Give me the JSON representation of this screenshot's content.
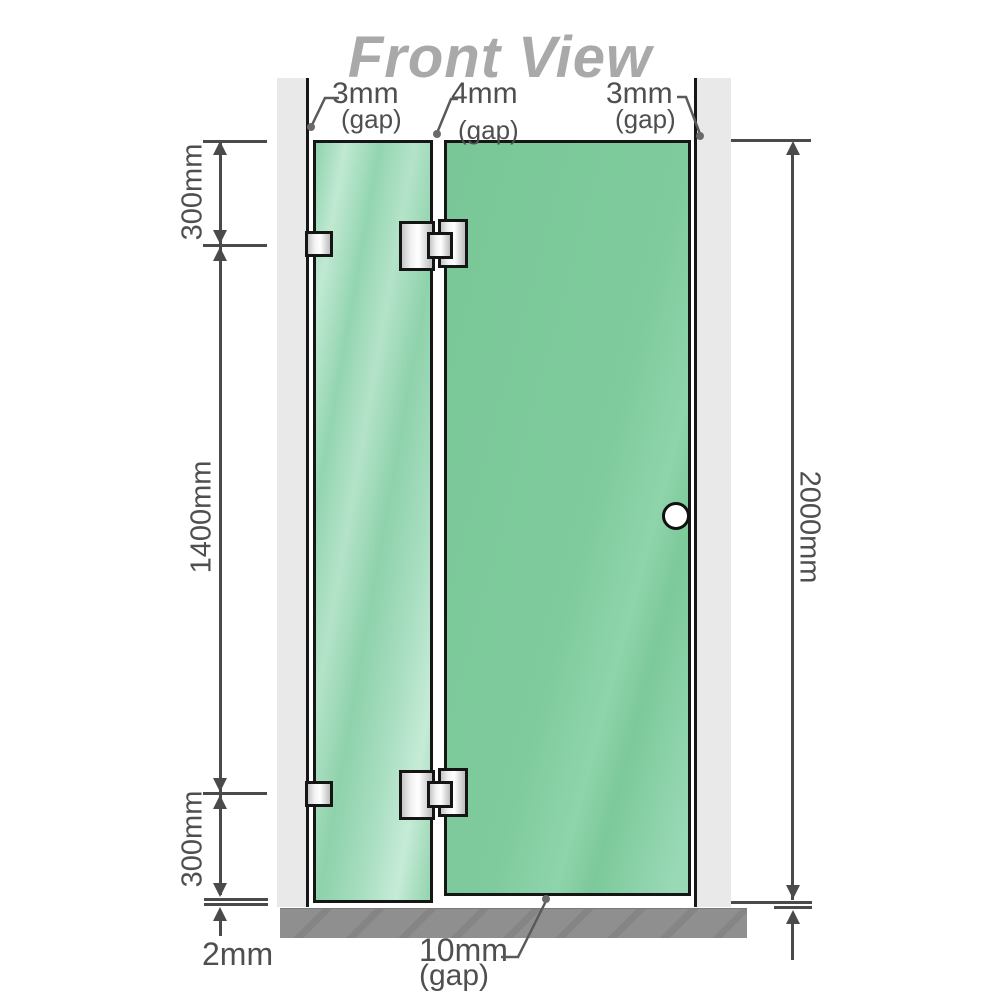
{
  "title": "Front View",
  "labels": {
    "top_gaps": [
      {
        "value": "3mm",
        "note": "(gap)"
      },
      {
        "value": "4mm",
        "note": "(gap)"
      },
      {
        "value": "3mm",
        "note": "(gap)"
      }
    ],
    "left_dimensions": [
      {
        "label": "300mm"
      },
      {
        "label": "1400mm"
      },
      {
        "label": "300mm"
      }
    ],
    "right_dimension": {
      "label": "2000mm"
    },
    "bottom": {
      "base_gap": {
        "label": "2mm"
      },
      "floor_gap": {
        "value": "10mm",
        "note": "(gap)"
      }
    }
  },
  "colors": {
    "glass_green": "#7ec99b",
    "panel_green_light": "#a7dcc0",
    "wall_gray": "#e9e9e9",
    "floor_gray": "#8f8f8f",
    "outline_black": "#161616",
    "dimension_gray": "#4a4a4a",
    "title_gray": "#a9a9a9",
    "metal_silver": "#e6e6e6"
  }
}
